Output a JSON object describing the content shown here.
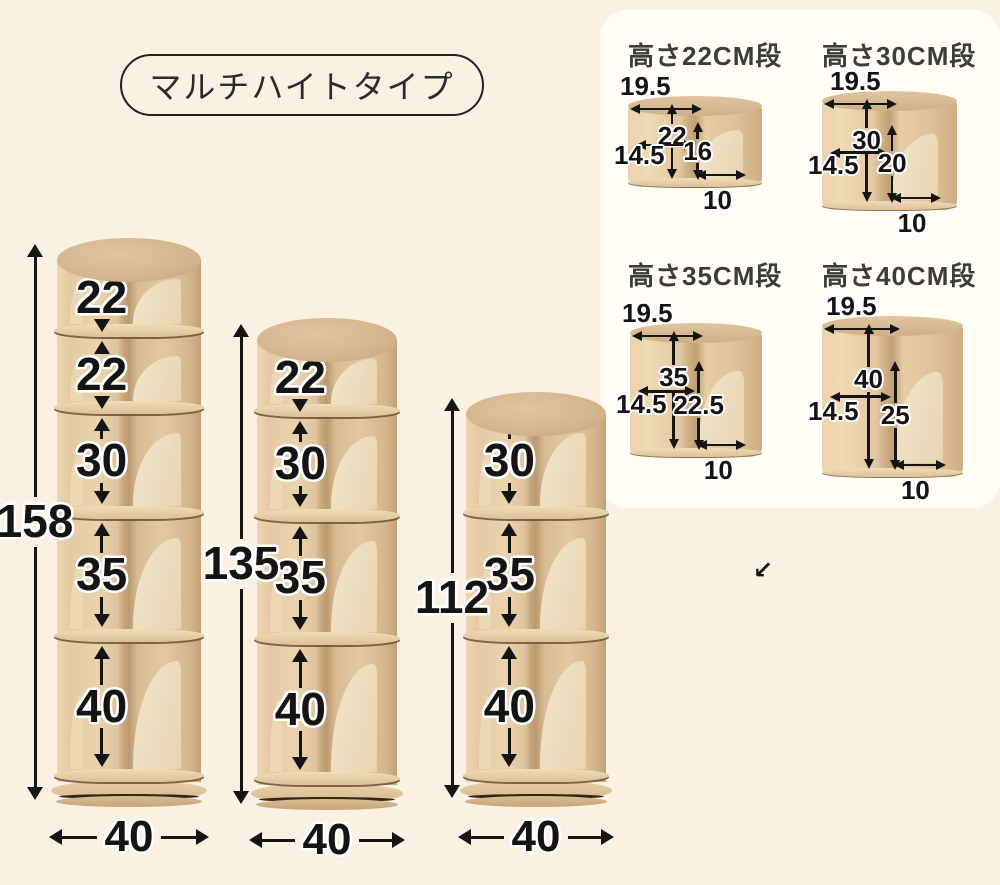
{
  "badge": {
    "label": "マルチハイトタイプ"
  },
  "towers": [
    {
      "total_height": "158",
      "base_width": "40",
      "tiers": [
        {
          "h": "22"
        },
        {
          "h": "22"
        },
        {
          "h": "30"
        },
        {
          "h": "35"
        },
        {
          "h": "40"
        }
      ]
    },
    {
      "total_height": "135",
      "base_width": "40",
      "tiers": [
        {
          "h": "22"
        },
        {
          "h": "30"
        },
        {
          "h": "35"
        },
        {
          "h": "40"
        }
      ]
    },
    {
      "total_height": "112",
      "base_width": "40",
      "tiers": [
        {
          "h": "30"
        },
        {
          "h": "35"
        },
        {
          "h": "40"
        }
      ]
    }
  ],
  "detail_panel": {
    "sections": [
      {
        "title": "高さ22CM段",
        "top_depth": "19.5",
        "tier_height": "22",
        "inner_width": "14.5",
        "divider_height": "16",
        "slot_width": "10"
      },
      {
        "title": "高さ30CM段",
        "top_depth": "19.5",
        "tier_height": "30",
        "inner_width": "14.5",
        "divider_height": "20",
        "slot_width": "10"
      },
      {
        "title": "高さ35CM段",
        "top_depth": "19.5",
        "tier_height": "35",
        "inner_width": "14.5",
        "divider_height": "22.5",
        "slot_width": "10"
      },
      {
        "title": "高さ40CM段",
        "top_depth": "19.5",
        "tier_height": "40",
        "inner_width": "14.5",
        "divider_height": "25",
        "slot_width": "10"
      }
    ]
  },
  "stray_arrow": {
    "glyph": "↙"
  },
  "colors": {
    "background": "#fbf1e2",
    "panel": "#fffdf6",
    "arrow": "#151515",
    "wood_light": "#f0e3c8",
    "wood_mid": "#e2c7a0",
    "wood_dark": "#c9a87c",
    "badge_border": "#222222",
    "title_text": "#3c3c3c"
  },
  "units": "cm"
}
